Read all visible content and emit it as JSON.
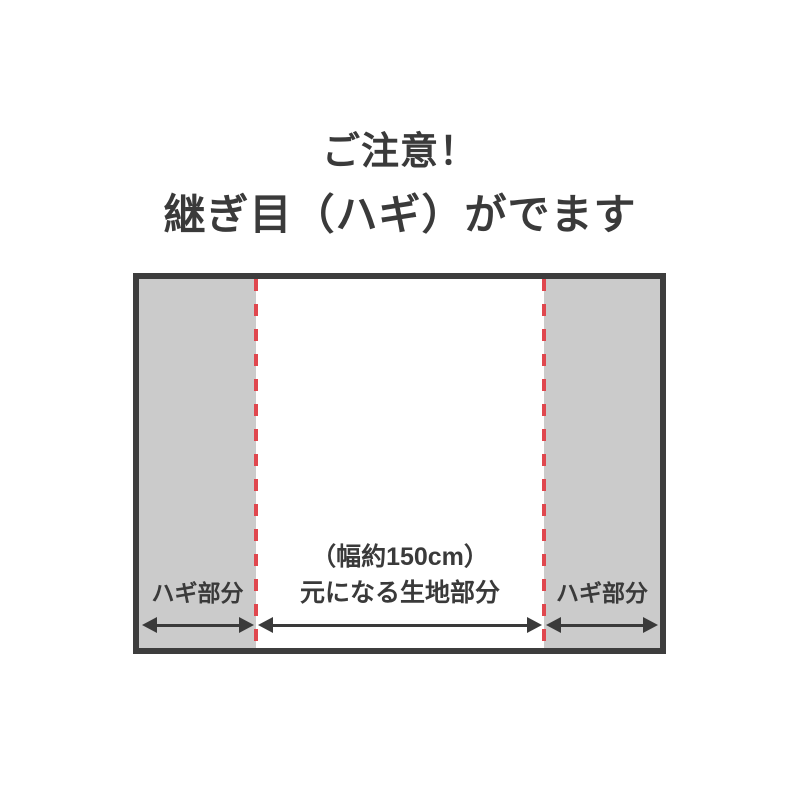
{
  "header": {
    "title": "ご注意！",
    "subtitle": "継ぎ目（ハギ）がでます"
  },
  "diagram": {
    "sections": [
      {
        "type": "seam",
        "label": "ハギ部分"
      },
      {
        "type": "main",
        "line1": "（幅約150cm）",
        "line2": "元になる生地部分"
      },
      {
        "type": "seam",
        "label": "ハギ部分"
      }
    ],
    "seam_line_count": 2,
    "colors": {
      "seam_fill": "#cbcbcb",
      "main_fill": "#ffffff",
      "border": "#3d3d3d",
      "seam_dashed_line": "#e0474e",
      "text": "#3a3a3a",
      "arrow": "#3a3a3a",
      "page_background": "#ffffff"
    }
  }
}
